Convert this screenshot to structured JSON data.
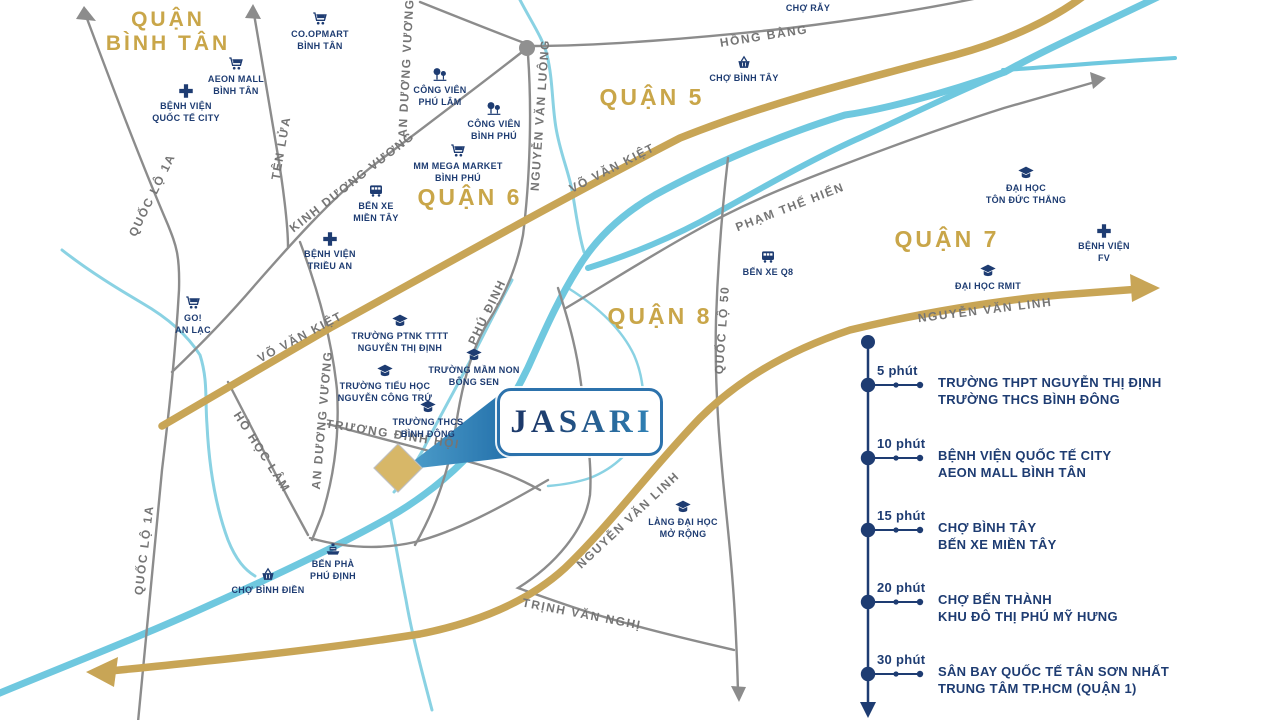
{
  "map": {
    "colors": {
      "navy": "#1E3C72",
      "gold_road": "#C8A556",
      "gold_text": "#C9A649",
      "river": "#6FC8DF",
      "creek": "#8AD2E3",
      "road_gray": "#8C8C8C",
      "label_gray": "#757575",
      "marker_gold": "#D7B768",
      "logo_blue": "#2C72AC"
    },
    "marker": {
      "logo": "JASARI"
    },
    "districts": [
      {
        "id": "quan-binh-tan",
        "lines": [
          "QUẬN",
          "BÌNH TÂN"
        ],
        "x": 168,
        "y": 8,
        "size": 21
      },
      {
        "id": "quan-5",
        "lines": [
          "QUẬN 5"
        ],
        "x": 652,
        "y": 84,
        "size": 23
      },
      {
        "id": "quan-6",
        "lines": [
          "QUẬN 6"
        ],
        "x": 470,
        "y": 184,
        "size": 23
      },
      {
        "id": "quan-7",
        "lines": [
          "QUẬN 7"
        ],
        "x": 947,
        "y": 226,
        "size": 23
      },
      {
        "id": "quan-8",
        "lines": [
          "QUẬN 8"
        ],
        "x": 660,
        "y": 303,
        "size": 23
      }
    ],
    "pois": [
      {
        "id": "co-opmart-binh-tan",
        "icon": "cart-icon",
        "lines": [
          "CO.OPMART",
          "BÌNH TÂN"
        ],
        "x": 320,
        "y": 10
      },
      {
        "id": "aeon-mall-binh-tan",
        "icon": "cart-icon",
        "lines": [
          "AEON MALL",
          "BÌNH TÂN"
        ],
        "x": 236,
        "y": 55
      },
      {
        "id": "benh-vien-quoc-te-city",
        "icon": "hospital-icon",
        "lines": [
          "BỆNH VIỆN",
          "QUỐC TẾ CITY"
        ],
        "x": 186,
        "y": 82
      },
      {
        "id": "cong-vien-phu-lam",
        "icon": "park-icon",
        "lines": [
          "CÔNG VIÊN",
          "PHÚ LÂM"
        ],
        "x": 440,
        "y": 66
      },
      {
        "id": "cong-vien-binh-phu",
        "icon": "park-icon",
        "lines": [
          "CÔNG VIÊN",
          "BÌNH PHÚ"
        ],
        "x": 494,
        "y": 100
      },
      {
        "id": "mm-mega-market",
        "icon": "cart-icon",
        "lines": [
          "MM MEGA MARKET",
          "BÌNH PHÚ"
        ],
        "x": 458,
        "y": 142
      },
      {
        "id": "ben-xe-mien-tay",
        "icon": "bus-icon",
        "lines": [
          "BẾN XE",
          "MIỀN TÂY"
        ],
        "x": 376,
        "y": 182
      },
      {
        "id": "benh-vien-trieu-an",
        "icon": "hospital-icon",
        "lines": [
          "BỆNH VIỆN",
          "TRIỀU AN"
        ],
        "x": 330,
        "y": 230
      },
      {
        "id": "go-an-lac",
        "icon": "cart-icon",
        "lines": [
          "GO!",
          "AN LẠC"
        ],
        "x": 193,
        "y": 294
      },
      {
        "id": "cho-ray",
        "icon": "basket-icon",
        "lines": [
          "CHỢ RẪY"
        ],
        "x": 808,
        "y": -16
      },
      {
        "id": "cho-binh-tay",
        "icon": "basket-icon",
        "lines": [
          "CHỢ BÌNH TÂY"
        ],
        "x": 744,
        "y": 54
      },
      {
        "id": "dai-hoc-ton-duc-thang",
        "icon": "school-icon",
        "lines": [
          "ĐẠI HỌC",
          "TÔN ĐỨC THẮNG"
        ],
        "x": 1026,
        "y": 164
      },
      {
        "id": "benh-vien-fv",
        "icon": "hospital-icon",
        "lines": [
          "BỆNH VIỆN",
          "FV"
        ],
        "x": 1104,
        "y": 222
      },
      {
        "id": "dai-hoc-rmit",
        "icon": "school-icon",
        "lines": [
          "ĐẠI HỌC RMIT"
        ],
        "x": 988,
        "y": 262
      },
      {
        "id": "ben-xe-q8",
        "icon": "bus-icon",
        "lines": [
          "BẾN XE Q8"
        ],
        "x": 768,
        "y": 248
      },
      {
        "id": "truong-ptnk-nguyen-thi-dinh",
        "icon": "school-icon",
        "lines": [
          "TRƯỜNG PTNK TTTT",
          "NGUYỄN THỊ ĐỊNH"
        ],
        "x": 400,
        "y": 312
      },
      {
        "id": "truong-mam-non-bong-sen",
        "icon": "school-icon",
        "lines": [
          "TRƯỜNG MẦM NON",
          "BÔNG SEN"
        ],
        "x": 474,
        "y": 346
      },
      {
        "id": "truong-tieu-hoc-nguyen-cong-tru",
        "icon": "school-icon",
        "lines": [
          "TRƯỜNG TIỂU HỌC",
          "NGUYỄN CÔNG TRỨ"
        ],
        "x": 385,
        "y": 362
      },
      {
        "id": "truong-thcs-binh-dong",
        "icon": "school-icon",
        "lines": [
          "TRƯỜNG THCS",
          "BÌNH ĐÔNG"
        ],
        "x": 428,
        "y": 398
      },
      {
        "id": "lang-dai-hoc-mo-rong",
        "icon": "school-icon",
        "lines": [
          "LÀNG ĐẠI HỌC",
          "MỞ RỘNG"
        ],
        "x": 683,
        "y": 498
      },
      {
        "id": "ben-pha-phu-dinh",
        "icon": "ferry-icon",
        "lines": [
          "BẾN PHÀ",
          "PHÚ ĐỊNH"
        ],
        "x": 333,
        "y": 540
      },
      {
        "id": "cho-binh-dien",
        "icon": "basket-icon",
        "lines": [
          "CHỢ BÌNH ĐIỀN"
        ],
        "x": 268,
        "y": 566
      }
    ],
    "road_labels": [
      {
        "text": "QUỐC LỘ 1A",
        "x": 152,
        "y": 195,
        "rot": -64
      },
      {
        "text": "TÊN LỬA",
        "x": 281,
        "y": 148,
        "rot": -80
      },
      {
        "text": "KINH DƯƠNG VƯƠNG",
        "x": 352,
        "y": 182,
        "rot": -38
      },
      {
        "text": "AN DƯƠNG VƯƠNG",
        "x": 406,
        "y": 68,
        "rot": -87
      },
      {
        "text": "NGUYỄN VĂN LUÔNG",
        "x": 540,
        "y": 115,
        "rot": -86
      },
      {
        "text": "HỒNG BÀNG",
        "x": 764,
        "y": 36,
        "rot": -9
      },
      {
        "text": "VÕ VĂN KIỆT",
        "x": 612,
        "y": 168,
        "rot": -27
      },
      {
        "text": "VÕ VĂN KIỆT",
        "x": 300,
        "y": 337,
        "rot": -28
      },
      {
        "text": "PHẠM THẾ HIỂN",
        "x": 790,
        "y": 207,
        "rot": -21
      },
      {
        "text": "QUỐC LỘ 50",
        "x": 722,
        "y": 330,
        "rot": -86
      },
      {
        "text": "NGUYỄN VĂN LINH",
        "x": 985,
        "y": 310,
        "rot": -7
      },
      {
        "text": "NGUYỄN VĂN LINH",
        "x": 628,
        "y": 520,
        "rot": -43
      },
      {
        "text": "TRỊNH VĂN NGHỊ",
        "x": 582,
        "y": 614,
        "rot": 11
      },
      {
        "text": "HỒ HỌC LÂM",
        "x": 262,
        "y": 452,
        "rot": 57
      },
      {
        "text": "AN DƯƠNG VƯƠNG",
        "x": 322,
        "y": 420,
        "rot": -85
      },
      {
        "text": "TRƯƠNG ĐÌNH HỘI",
        "x": 393,
        "y": 434,
        "rot": 9
      },
      {
        "text": "PHÚ ĐỊNH",
        "x": 487,
        "y": 312,
        "rot": -64
      },
      {
        "text": "QUỐC LỘ 1A",
        "x": 144,
        "y": 550,
        "rot": -83
      }
    ]
  },
  "legend": {
    "items": [
      {
        "time": "5 phút",
        "lines": [
          "TRƯỜNG THPT NGUYỄN THỊ ĐỊNH",
          "TRƯỜNG THCS BÌNH ĐÔNG"
        ]
      },
      {
        "time": "10 phút",
        "lines": [
          "BỆNH VIỆN QUỐC TẾ CITY",
          "AEON MALL BÌNH TÂN"
        ]
      },
      {
        "time": "15 phút",
        "lines": [
          "CHỢ BÌNH TÂY",
          "BẾN XE MIỀN TÂY"
        ]
      },
      {
        "time": "20 phút",
        "lines": [
          "CHỢ BẾN THÀNH",
          "KHU ĐÔ THỊ PHÚ MỸ HƯNG"
        ]
      },
      {
        "time": "30 phút",
        "lines": [
          "SÂN BAY QUỐC TẾ TÂN SƠN NHẤT",
          "TRUNG TÂM TP.HCM (QUẬN 1)"
        ]
      }
    ]
  }
}
